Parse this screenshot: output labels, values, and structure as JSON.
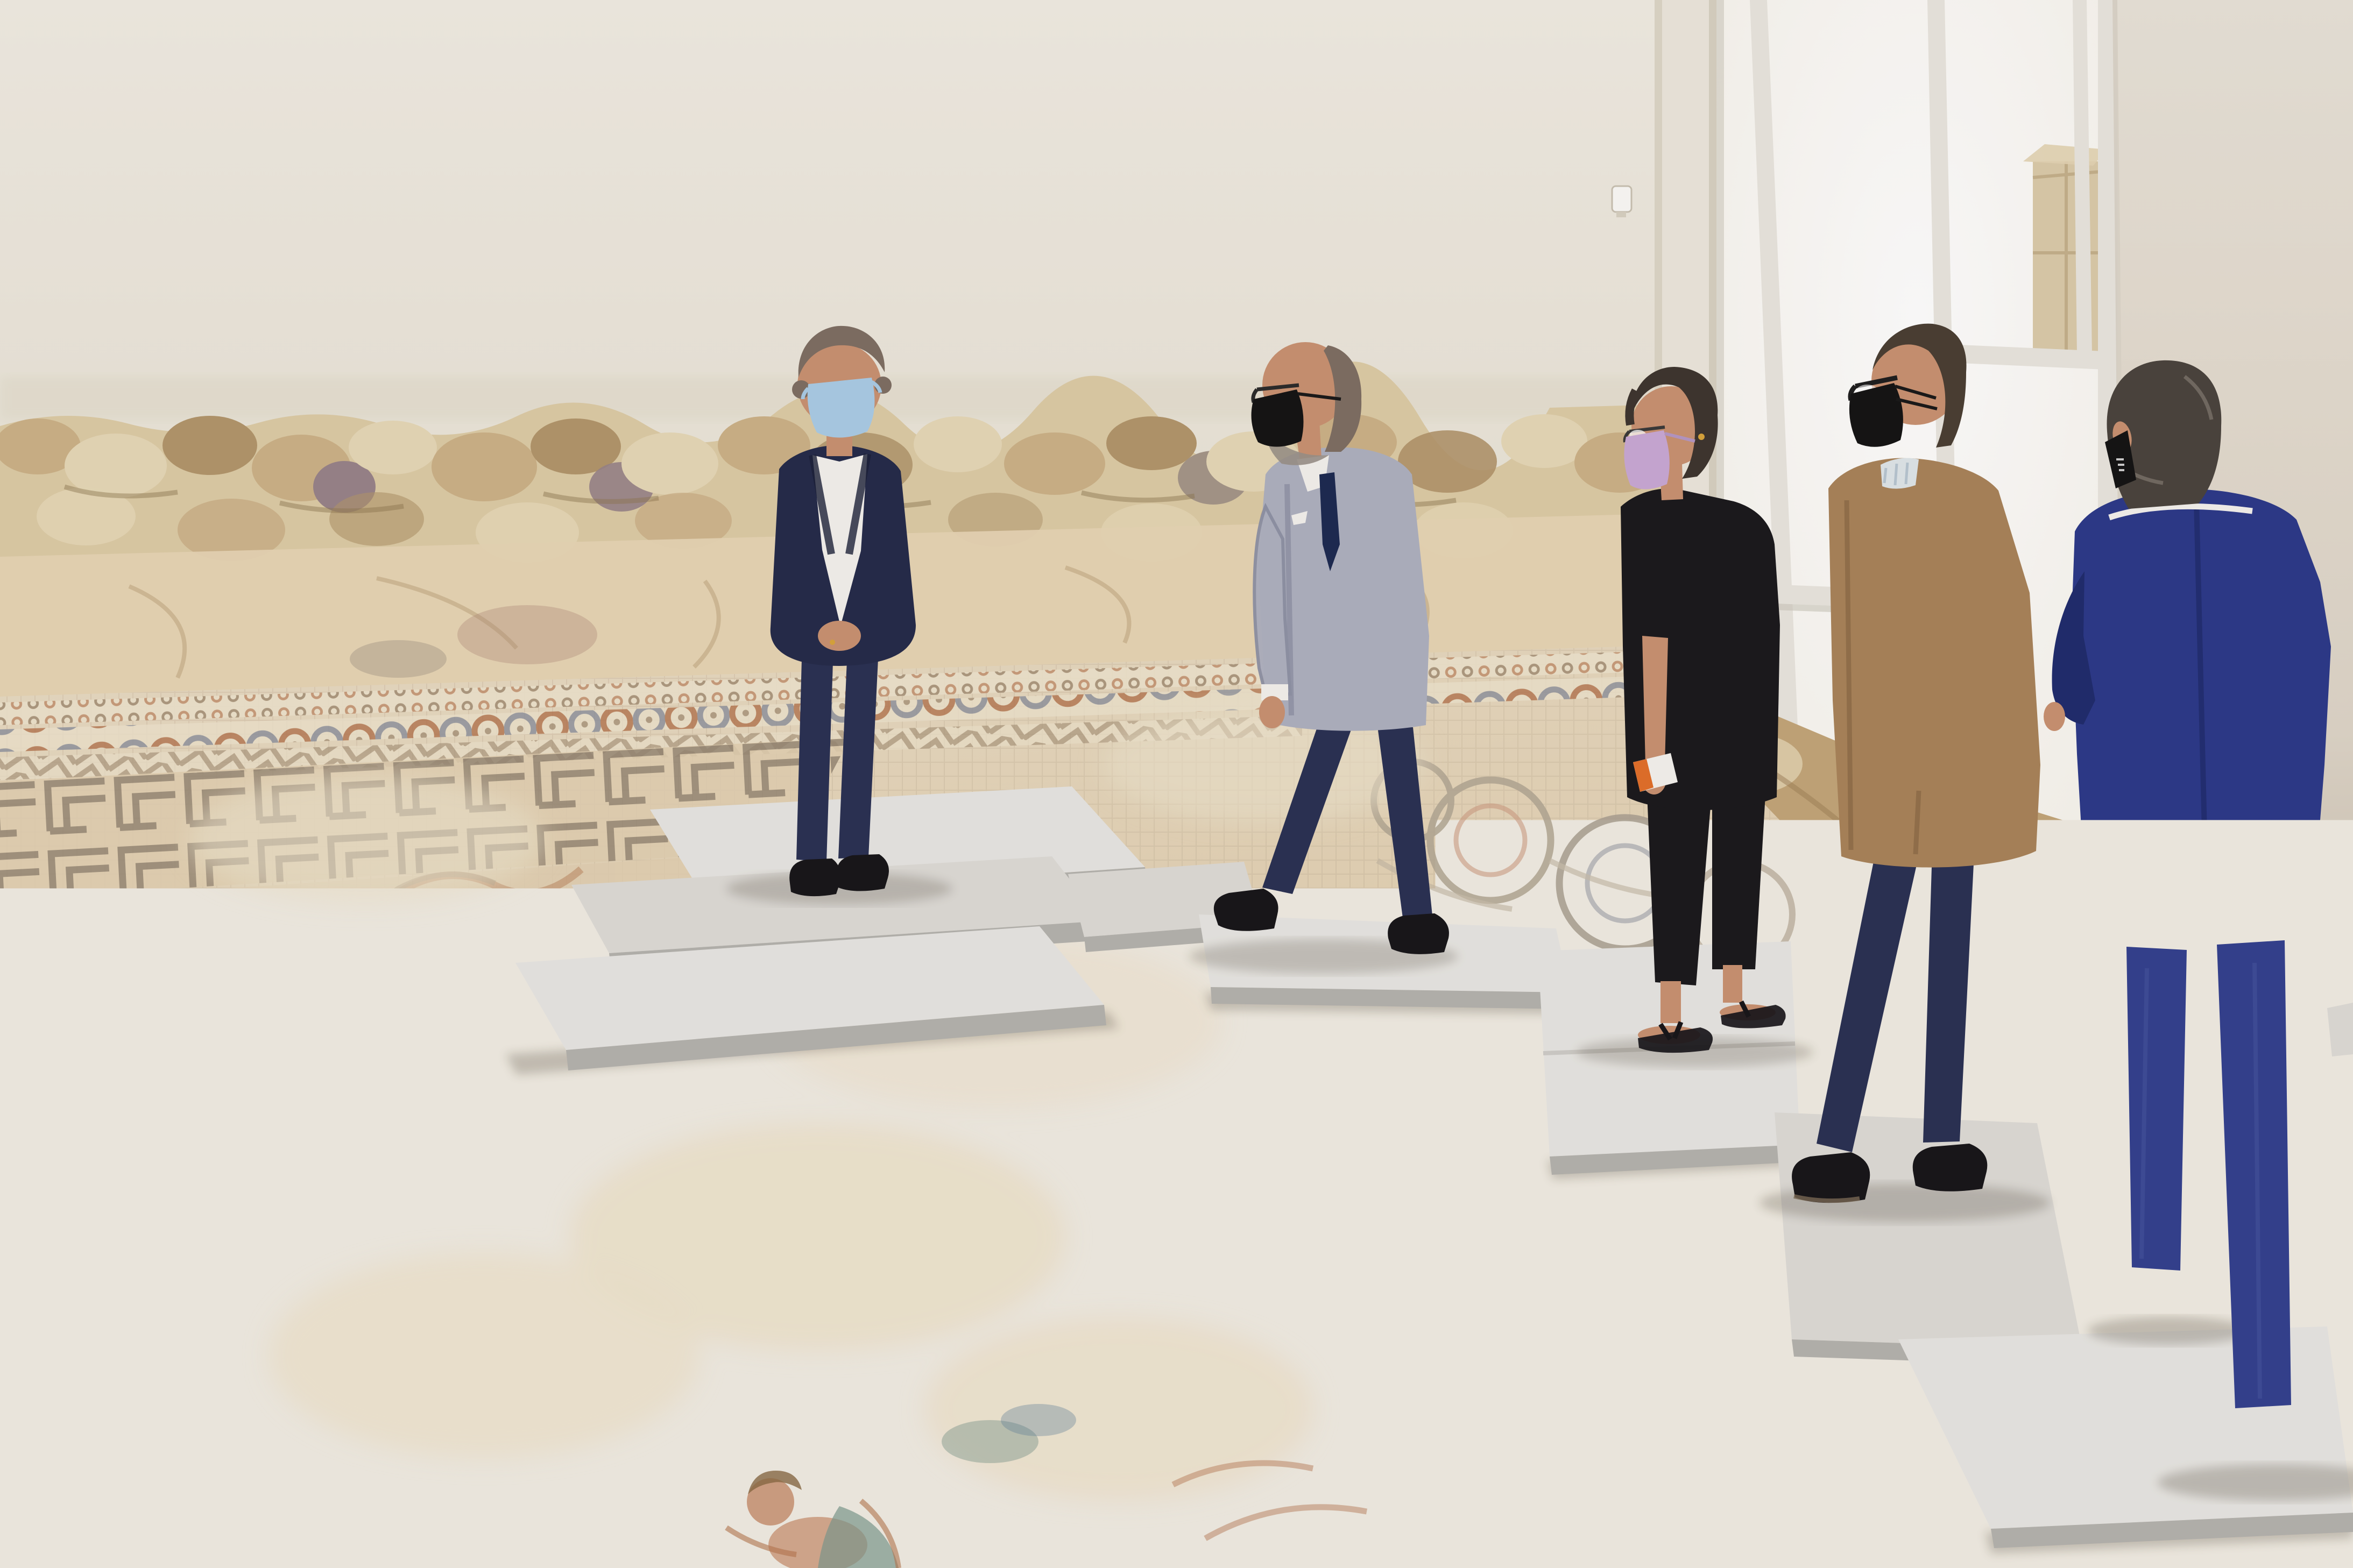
{
  "meta": {
    "type": "photograph",
    "description": "Five officials wearing protective face masks visit a restored Roman mosaic hall, walking over the ancient pavement on raised white protection boards.",
    "setting": "Museum hall of a Roman villa: white plaster walls above an excavated rubble-stone wall base, a tall bright window on the right, and a large geometric mosaic floor."
  },
  "scene": {
    "back_wall": "white plaster upper wall",
    "stone_band": "ancient rubble stone wall base",
    "corner_pillar": "white corner pillar with small alarm sensor",
    "window": "tall overexposed window with white mullions",
    "wall_panel": "white partition panel on the right",
    "box_behind_glass": "cardboard boxes seen through the window",
    "mosaic_floor": "Roman mosaic with guilloche braids, Greek-key meanders, interlaced circle medallions, faded figurative panels and a red checkered patch",
    "walkway": "white foam protection boards forming a visitor path",
    "board_count": 9,
    "people_count": 5
  },
  "people": [
    {
      "id": "man-navy",
      "description": "Man in dark navy suit with light blue surgical mask standing on the boards, fastening his jacket, looking down at the mosaic",
      "mask_color": "light blue",
      "outfit": "dark navy suit, white open-collar shirt",
      "pose": "standing, hands at jacket button"
    },
    {
      "id": "man-gray",
      "description": "Gray-haired man with glasses and black mask in a light gray blazer with dark tie, walking left across the boards",
      "mask_color": "black",
      "outfit": "light gray blazer, white shirt, dark blue tie, navy trousers",
      "pose": "walking in profile"
    },
    {
      "id": "woman-black",
      "description": "Woman with short dark hair, glasses and lilac mask, dressed in black with sandals, holding a small white object",
      "mask_color": "lilac",
      "outfit": "black loose top, black cropped trousers, black sandals",
      "pose": "walking in profile"
    },
    {
      "id": "man-camel",
      "description": "Balding man with glasses and black mask wearing a camel jacket over a striped shirt with navy trousers",
      "mask_color": "black",
      "outfit": "camel jacket, light striped shirt, navy trousers, black shoes",
      "pose": "standing in profile, head bowed"
    },
    {
      "id": "man-blue",
      "description": "Man seen from behind in a cobalt blue suit with black mask edge visible, arms folded in front",
      "mask_color": "black",
      "outfit": "cobalt blue suit, white shirt collar",
      "pose": "standing, back to camera"
    }
  ],
  "props": {
    "hand_object": "small white tube with orange label carried by the woman",
    "sensor": "white wall sensor",
    "ring": "gold ring on first man's hand"
  },
  "palette": {
    "wallTop": "#f1ede3",
    "wallBottom": "#e8e2d4",
    "pillar": "#ede8dd",
    "pillarEdge": "#d8d2c2",
    "windowGlow": "#fdfcf8",
    "mullion": "#eae7df",
    "mullionShade": "#ccc8bc",
    "panelTop": "#e9e3d9",
    "panelBottom": "#c8bfae",
    "boxCardboard": "#d8c7a3",
    "boxLine": "#b5a078",
    "stoneBase": "#ddcca6",
    "stoneLight": "#e7d9b8",
    "stoneTan": "#cdb288",
    "stoneDark": "#b2966c",
    "stoneShadow": "#8f7850",
    "stoneGray": "#a59689",
    "stonePurple": "#98848a",
    "stoneLower": "#e8d7b6",
    "rightStone": "#c3a679",
    "rightStoneDark": "#9d7f58",
    "floorFar": "#e9dcc4",
    "floorBase": "#e2d1b2",
    "floorNear": "#dcc9a8",
    "floorLight": "#efe4cd",
    "tessLine": "#a8947a",
    "tessDark": "#7d705e",
    "tessBlue": "#8d929e",
    "tessRust": "#b5764f",
    "tessPink": "#cf9d83",
    "tessRed": "#a84f33",
    "tessGreen": "#7e9a8f",
    "boardTop": "#e8e7e3",
    "boardTop2": "#dedcd7",
    "boardEdge": "#b5b3ae",
    "boardSide": "#cfcdc8",
    "skin": "#c99272",
    "skinDark": "#a87456",
    "hairGray": "#7e6f63",
    "hairDark": "#3e362f",
    "hairMan5": "#4a443e",
    "maskBlue": "#aacde6",
    "maskBlack": "#141414",
    "maskLilac": "#c9a9d6",
    "navySuit": "#252b4a",
    "navyTrousers": "#2a3154",
    "shirtWhite": "#f4f2ee",
    "grayBlazer": "#aeb1c0",
    "grayBlazerShade": "#8f93a6",
    "tieNavy": "#1d2a52",
    "blackCloth": "#1b1a1d",
    "camel": "#a9845a",
    "camelShade": "#8a6a45",
    "blueSuit": "#2c3a8a",
    "blueSuitShade": "#202c6e",
    "blueTrousers": "#33418f",
    "shoeBlack": "#17161a",
    "whiteObj": "#f5f3ef",
    "orangeLabel": "#e2702a",
    "gold": "#d9a53c"
  }
}
